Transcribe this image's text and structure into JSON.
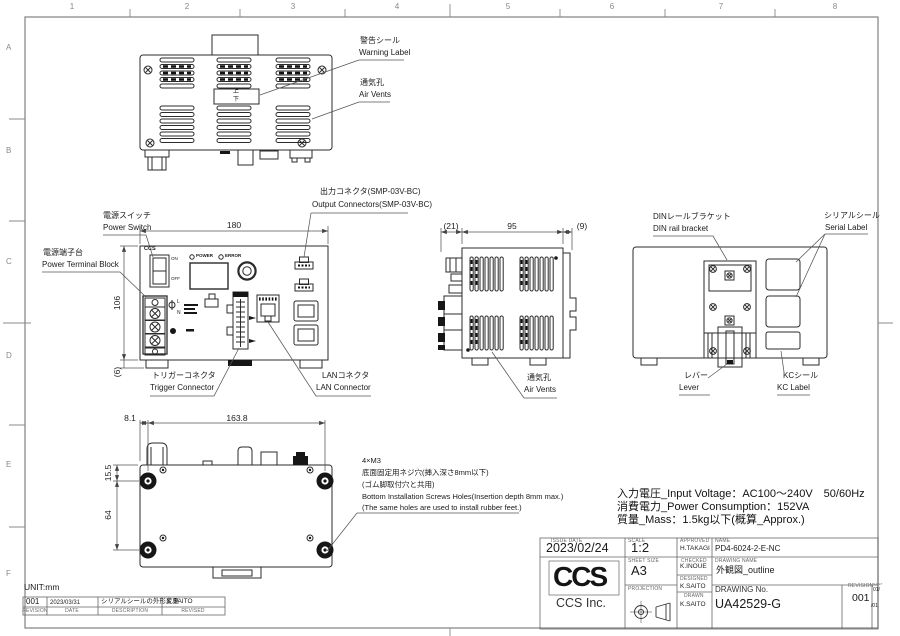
{
  "frame": {
    "cols": [
      "1",
      "2",
      "3",
      "4",
      "5",
      "6",
      "7",
      "8"
    ],
    "rows": [
      "A",
      "B",
      "C",
      "D",
      "E",
      "F"
    ],
    "unit_note": "UNIT:mm"
  },
  "top_view": {
    "warning": {
      "jp": "警告シール",
      "en": "Warning Label"
    },
    "vents": {
      "jp": "通気孔",
      "en": "Air Vents"
    },
    "orientation": {
      "top": "上",
      "bottom": "下"
    }
  },
  "front_view": {
    "dims": {
      "width": "180",
      "height": "106",
      "foot": "(6)"
    },
    "power_switch": {
      "jp": "電源スイッチ",
      "en": "Power Switch"
    },
    "terminal": {
      "jp": "電源端子台",
      "en": "Power Terminal Block"
    },
    "output": {
      "jp": "出力コネクタ(SMP-03V-BC)",
      "en": "Output Connectors(SMP-03V-BC)"
    },
    "trigger": {
      "jp": "トリガーコネクタ",
      "en": "Trigger Connector"
    },
    "lan": {
      "jp": "LANコネクタ",
      "en": "LAN Connector"
    },
    "panel": {
      "logo": "CCS",
      "on": "ON",
      "off": "OFF",
      "power": "POWER",
      "error": "ERROR",
      "line": "L",
      "neutral": "N"
    }
  },
  "side_view": {
    "dims": {
      "left": "(21)",
      "width": "95",
      "right": "(9)"
    },
    "vents": {
      "jp": "通気孔",
      "en": "Air Vents"
    }
  },
  "rear_view": {
    "din": {
      "jp": "DINレールブラケット",
      "en": "DIN rail bracket"
    },
    "serial": {
      "jp": "シリアルシール",
      "en": "Serial Label"
    },
    "lever": {
      "jp": "レバー",
      "en": "Lever"
    },
    "kc": {
      "jp": "KCシール",
      "en": "KC Label"
    }
  },
  "bottom_view": {
    "dims": {
      "offset": "8.1",
      "width": "163.8",
      "top": "15.5",
      "height": "64"
    },
    "notes": [
      "4×M3",
      "底面固定用ネジ穴(挿入深さ8mm以下)",
      "(ゴム脚取付穴と共用)",
      "Bottom Installation Screws Holes(Insertion depth 8mm max.)",
      "(The same holes are used to install rubber feet.)"
    ]
  },
  "specs": {
    "line1": "入力電圧_Input Voltage：AC100～240V　50/60Hz",
    "line2": "消費電力_Power Consumption：152VA",
    "line3": "質量_Mass：1.5kg以下(概算_Approx.)"
  },
  "title_block": {
    "issue_date_label": "ISSUE DATE",
    "issue_date": "2023/02/24",
    "scale_label": "SCALE",
    "scale": "1:2",
    "approved_label": "APPROVED",
    "approved": "H.TAKAGI",
    "name_label": "NAME",
    "name": "PD4-6024-2-E-NC",
    "sheet_size_label": "SHEET SIZE",
    "sheet_size": "A3",
    "checked_label": "CHECKED",
    "checked": "K.INOUE",
    "drawing_name_label": "DRAWING NAME",
    "drawing_name": "外観図_outline",
    "projection_label": "PROJECTION",
    "designed_label": "DESIGNED",
    "designed": "K.SAITO",
    "drawn_label": "DRAWN",
    "drawn": "K.SAITO",
    "drawing_no_label": "DRAWING No.",
    "drawing_no": "UA42529-G",
    "revision_label": "REVISION",
    "sheet_label": "SHEET",
    "revision": "001",
    "sheet_top": "01/",
    "sheet_bottom": "/01",
    "company": "CCS Inc.",
    "logo_text": "CCS"
  },
  "revision_table": {
    "headers": {
      "rev": "REVISION",
      "date": "DATE",
      "description": "DESCRIPTION",
      "by": "REVISED"
    },
    "row": {
      "rev": "001",
      "date": "2023/03/31",
      "description": "シリアルシールの外形変更",
      "by": "K.SAITO"
    }
  }
}
